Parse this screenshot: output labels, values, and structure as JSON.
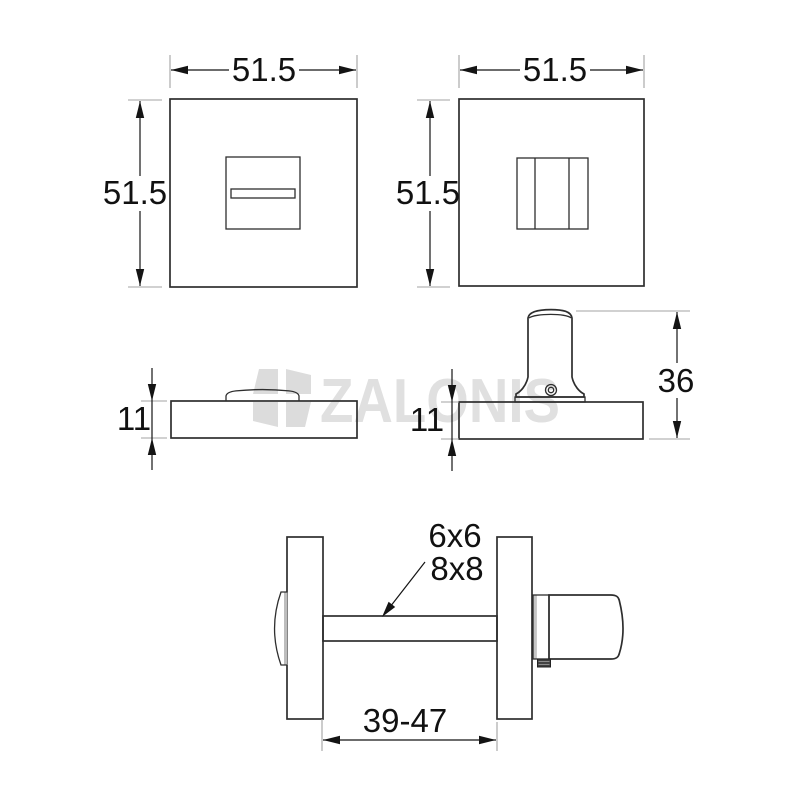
{
  "page": {
    "background": "#ffffff"
  },
  "watermark": {
    "brand": "ZALONIS",
    "color": "#e0e0e0",
    "logo_color": "#dcdcdc"
  },
  "lines": {
    "outline_color": "#2e2e2e",
    "dimension_color": "#141414",
    "extension_color": "#a3a3a3"
  },
  "dims": {
    "front_left_width": "51.5",
    "front_left_height": "51.5",
    "front_right_width": "51.5",
    "front_right_height": "51.5",
    "side_left_thickness": "11",
    "side_right_thickness": "11",
    "thumbturn_height": "36",
    "spindle_size_top": "6x6",
    "spindle_size_bottom": "8x8",
    "spindle_span": "39-47"
  }
}
